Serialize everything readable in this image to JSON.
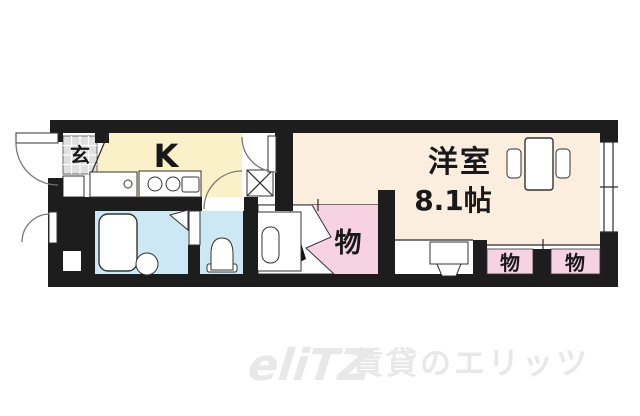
{
  "rooms": {
    "entrance": {
      "label": "玄"
    },
    "kitchen": {
      "label": "K"
    },
    "western_room": {
      "name": "洋室",
      "size": "8.1帖"
    },
    "closet": {
      "label": "物"
    },
    "storage_right_1": {
      "label": "物"
    },
    "storage_right_2": {
      "label": "物"
    }
  },
  "watermark": {
    "logo": "eliTZ",
    "text": "賃貸のエリッツ"
  },
  "colors": {
    "wall": "#1d1d1d",
    "kitchen_floor": "#faf1c9",
    "western_room_floor": "#fceede",
    "wet_area_floor": "#cde8f5",
    "closet_fill": "#f7d2e0",
    "entrance_tile": "#e0e0e0",
    "watermark": "#e8e8e8"
  }
}
